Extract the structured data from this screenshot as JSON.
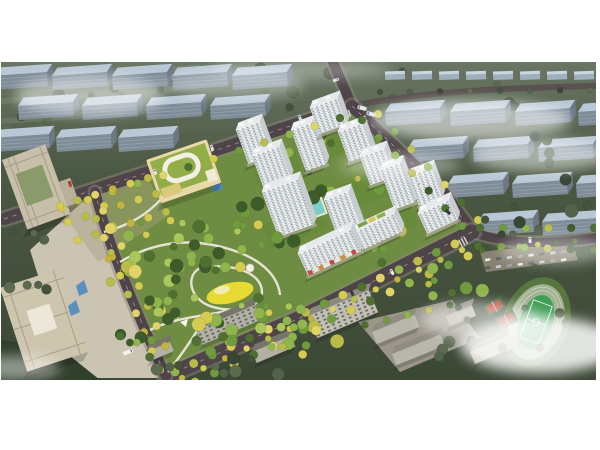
{
  "scene": {
    "description": "Aerial architectural rendering of a residential development master plan: white high-rise apartment towers around green courtyards, a large central landscaped park with winding white paths and a yellow playground, a kindergarten with a green roof, beige office towers on the left, tree-lined roads, a school with running track and basketball courts at lower right, surrounded by blue-grey context building blocks and drifting white fog",
    "image_width": 600,
    "image_height": 450,
    "render_area": {
      "x": 1,
      "y": 62,
      "w": 595,
      "h": 318
    }
  },
  "colors": {
    "canvas": "#ffffff",
    "ground_top": "#6a7663",
    "ground_mid": "#4b5843",
    "ground_bottom": "#3c4836",
    "site_green": "#6e8c42",
    "road": "#4e4449",
    "road_minor": "#5a5250",
    "sidewalk": "#8d867c",
    "road_dash": "#cfcac2",
    "context_roof": "#b9c8d6",
    "context_face": "#7f8d99",
    "context_side": "#6b7884",
    "context_line": "#95a3af",
    "tower_face": "#f0f2f0",
    "tower_side": "#c6ccd0",
    "tower_roof": "#e6e9eb",
    "window": "#5e6f7c",
    "gray_face": "#b3b1a6",
    "gray_roof": "#77746a",
    "office": "#cbc3ad",
    "office_shade": "#a79f89",
    "kindergarten_roof": "#93ae49",
    "kindergarten_wall": "#e9d9a9",
    "park_path": "#ebe8da",
    "playground": "#e8da34",
    "plaza": "#cbc4b2",
    "track_ring": "#a3b291",
    "pitch": "#3f9e58",
    "court": "#b44b3a",
    "pool": "#7ccdc9",
    "cloud": "#ffffff",
    "awning": [
      "#c9473e",
      "#e9e5da",
      "#d8863c",
      "#e9e5da"
    ]
  },
  "palettes": {
    "park": [
      "#4e7030",
      "#6f9a3e",
      "#8fb54c",
      "#3d5c2a",
      "#a9c75a",
      "#d3cb52"
    ],
    "site": [
      "#4e7030",
      "#6f9a3e",
      "#8fb54c",
      "#b9bc48",
      "#3d5c2a"
    ],
    "yellow": [
      "#d3cb52",
      "#b9bc48",
      "#e0d468",
      "#c4b43e"
    ],
    "mix": [
      "#d3cb52",
      "#6f9a3e",
      "#b9bc48",
      "#8fb54c",
      "#e0d468",
      "#4e7030"
    ],
    "context": [
      "#44523c",
      "#53624a",
      "#394635",
      "#5c6b50"
    ]
  },
  "context_slabs": [
    [
      -8,
      76
    ],
    [
      52,
      76
    ],
    [
      112,
      76
    ],
    [
      172,
      76
    ],
    [
      232,
      76
    ],
    [
      18,
      106
    ],
    [
      82,
      106
    ],
    [
      146,
      106
    ],
    [
      210,
      106
    ],
    [
      -6,
      138
    ],
    [
      56,
      138
    ],
    [
      118,
      138
    ],
    [
      385,
      112
    ],
    [
      450,
      112
    ],
    [
      515,
      112
    ],
    [
      578,
      112
    ],
    [
      408,
      148
    ],
    [
      473,
      148
    ],
    [
      538,
      148
    ],
    [
      448,
      184
    ],
    [
      512,
      184
    ],
    [
      576,
      184
    ],
    [
      478,
      222
    ],
    [
      542,
      222
    ]
  ],
  "houses": [
    [
      385,
      74
    ],
    [
      412,
      74
    ],
    [
      439,
      74
    ],
    [
      466,
      74
    ],
    [
      493,
      74
    ],
    [
      520,
      74
    ],
    [
      547,
      74
    ],
    [
      574,
      74
    ]
  ],
  "roads": [
    {
      "d": "M 4,219 L 352,106",
      "w": 12,
      "sw": true,
      "dash": true
    },
    {
      "d": "M 352,106 L 333,62",
      "w": 10,
      "sw": true,
      "dash": false
    },
    {
      "d": "M 352,106 C 420,92 500,88 596,86",
      "w": 6,
      "sw": false,
      "dash": false,
      "minor": true
    },
    {
      "d": "M 352,106 L 445,195 L 472,232",
      "w": 12,
      "sw": true,
      "dash": true
    },
    {
      "d": "M 472,232 C 515,247 558,243 596,238",
      "w": 9,
      "sw": true,
      "dash": false
    },
    {
      "d": "M 472,232 L 300,318 L 166,376",
      "w": 15,
      "sw": true,
      "dash": true
    },
    {
      "d": "M 95,192 C 110,250 135,310 166,376",
      "w": 10,
      "sw": true,
      "dash": true
    }
  ],
  "towers": [
    {
      "x": 236,
      "y": 130,
      "w": 25,
      "fh": 36,
      "rot": -20
    },
    {
      "x": 252,
      "y": 156,
      "w": 29,
      "fh": 34,
      "rot": -20
    },
    {
      "x": 291,
      "y": 130,
      "w": 22,
      "fh": 44,
      "rot": -20
    },
    {
      "x": 310,
      "y": 108,
      "w": 29,
      "fh": 28,
      "rot": -20
    },
    {
      "x": 338,
      "y": 132,
      "w": 26,
      "fh": 32,
      "rot": -20
    },
    {
      "x": 360,
      "y": 157,
      "w": 26,
      "fh": 30,
      "rot": -20
    },
    {
      "x": 380,
      "y": 170,
      "w": 22,
      "fh": 42,
      "rot": -20
    },
    {
      "x": 262,
      "y": 192,
      "w": 38,
      "fh": 48,
      "rot": -20
    },
    {
      "x": 324,
      "y": 200,
      "w": 26,
      "fh": 38,
      "rot": -20
    },
    {
      "x": 408,
      "y": 176,
      "w": 25,
      "fh": 32,
      "rot": -20
    },
    {
      "x": 354,
      "y": 232,
      "w": 44,
      "fh": 20,
      "rot": -25,
      "roofGarden": true
    },
    {
      "x": 298,
      "y": 254,
      "w": 58,
      "fh": 24,
      "rot": -25,
      "storefront": true
    },
    {
      "x": 418,
      "y": 214,
      "w": 34,
      "fh": 22,
      "rot": -25
    }
  ],
  "gray_slabs": [
    {
      "x": 196,
      "y": 330,
      "w": 64,
      "h": 16,
      "rot": -23,
      "win": true
    },
    {
      "x": 252,
      "y": 352,
      "w": 42,
      "h": 12,
      "rot": -23
    },
    {
      "x": 308,
      "y": 316,
      "w": 66,
      "h": 24,
      "rot": -23,
      "win": true,
      "face": "#c2bfb4",
      "roof": "#8c8a80"
    },
    {
      "x": 146,
      "y": 352,
      "w": 26,
      "h": 10,
      "rot": -23
    },
    {
      "x": 372,
      "y": 332,
      "w": 46,
      "h": 13,
      "rot": -22,
      "face": "#b9b6ab",
      "roof": "#8f8c81"
    },
    {
      "x": 392,
      "y": 354,
      "w": 52,
      "h": 12,
      "rot": -22,
      "face": "#b9b6ab",
      "roof": "#8f8c81"
    },
    {
      "x": 446,
      "y": 316,
      "w": 28,
      "h": 11,
      "rot": -22,
      "face": "#b9b6ab",
      "roof": "#8f8c81"
    },
    {
      "x": 470,
      "y": 352,
      "w": 40,
      "h": 13,
      "rot": -23
    }
  ],
  "tree_rows": [
    [
      62,
      208,
      340,
      118,
      12,
      4,
      "mix"
    ],
    [
      362,
      120,
      462,
      226,
      7,
      4,
      "site"
    ],
    [
      378,
      114,
      478,
      220,
      7,
      4,
      "mix"
    ],
    [
      455,
      244,
      175,
      372,
      16,
      4.5,
      "mix"
    ],
    [
      468,
      256,
      195,
      382,
      15,
      4.5,
      "mix"
    ],
    [
      462,
      250,
      182,
      378,
      14,
      3.2,
      "yellow"
    ],
    [
      88,
      200,
      160,
      370,
      10,
      4,
      "yellow"
    ],
    [
      104,
      206,
      174,
      366,
      9,
      4,
      "yellow"
    ],
    [
      480,
      228,
      594,
      228,
      6,
      4,
      "site"
    ],
    [
      478,
      246,
      594,
      250,
      6,
      4,
      "site"
    ],
    [
      60,
      206,
      148,
      178,
      6,
      4,
      "yellow"
    ],
    [
      68,
      222,
      156,
      194,
      6,
      4,
      "yellow"
    ],
    [
      78,
      240,
      166,
      212,
      6,
      4,
      "yellow"
    ],
    [
      482,
      250,
      575,
      241,
      6,
      3,
      "site"
    ],
    [
      365,
      325,
      450,
      305,
      5,
      3.5,
      "site"
    ],
    [
      380,
      92,
      590,
      90,
      8,
      3,
      "context"
    ]
  ],
  "tree_clusters": [
    {
      "cx": 290,
      "cy": 92,
      "rx": 290,
      "ry": 26,
      "n": 24,
      "seed": 7,
      "pal": "context",
      "layer": "back"
    },
    {
      "cx": 70,
      "cy": 125,
      "rx": 75,
      "ry": 38,
      "n": 9,
      "seed": 10,
      "pal": "context",
      "layer": "back"
    },
    {
      "cx": 330,
      "cy": 178,
      "rx": 68,
      "ry": 48,
      "n": 20,
      "seed": 6,
      "pal": "site",
      "layer": "court"
    },
    {
      "cx": 380,
      "cy": 240,
      "rx": 40,
      "ry": 25,
      "n": 8,
      "seed": 12,
      "pal": "site",
      "layer": "court"
    },
    {
      "cx": 170,
      "cy": 245,
      "rx": 55,
      "ry": 42,
      "n": 24,
      "seed": 1,
      "pal": "park",
      "layer": "front"
    },
    {
      "cx": 215,
      "cy": 305,
      "rx": 65,
      "ry": 48,
      "n": 26,
      "seed": 2,
      "pal": "park",
      "layer": "front"
    },
    {
      "cx": 262,
      "cy": 228,
      "rx": 42,
      "ry": 28,
      "n": 13,
      "seed": 3,
      "pal": "park",
      "layer": "front"
    },
    {
      "cx": 148,
      "cy": 330,
      "rx": 38,
      "ry": 30,
      "n": 12,
      "seed": 4,
      "pal": "park",
      "layer": "front"
    },
    {
      "cx": 282,
      "cy": 318,
      "rx": 30,
      "ry": 22,
      "n": 9,
      "seed": 5,
      "pal": "park",
      "layer": "front"
    },
    {
      "cx": 120,
      "cy": 255,
      "rx": 20,
      "ry": 35,
      "n": 8,
      "seed": 11,
      "pal": "yellow",
      "layer": "front"
    },
    {
      "cx": 532,
      "cy": 205,
      "rx": 64,
      "ry": 70,
      "n": 14,
      "seed": 8,
      "pal": "context",
      "layer": "front"
    },
    {
      "cx": 505,
      "cy": 330,
      "rx": 88,
      "ry": 42,
      "n": 12,
      "seed": 9,
      "pal": "context",
      "layer": "front"
    },
    {
      "cx": 28,
      "cy": 262,
      "rx": 26,
      "ry": 55,
      "n": 7,
      "seed": 13,
      "pal": "context",
      "layer": "front"
    },
    {
      "cx": 250,
      "cy": 368,
      "rx": 110,
      "ry": 12,
      "n": 9,
      "seed": 14,
      "pal": "context",
      "layer": "front"
    },
    {
      "cx": 452,
      "cy": 282,
      "rx": 40,
      "ry": 18,
      "n": 7,
      "seed": 15,
      "pal": "site",
      "layer": "front"
    },
    {
      "cx": 300,
      "cy": 340,
      "rx": 60,
      "ry": 16,
      "n": 10,
      "seed": 16,
      "pal": "mix",
      "layer": "front"
    }
  ],
  "park_paths": [
    "M 120,262 C 160,238 200,238 238,252 C 262,261 278,276 280,295",
    "M 200,268 C 230,262 262,272 262,292 C 262,308 232,314 210,306 C 190,299 185,276 200,268 Z",
    "M 104,232 C 130,225 148,214 162,198",
    "M 168,372 C 185,350 195,335 205,318",
    "M 150,330 C 185,312 225,318 258,300"
  ],
  "vehicles": [
    [
      70,
      184,
      -17,
      3,
      6,
      "#b8413a"
    ],
    [
      155,
      172,
      -17,
      3,
      6,
      "#dfe2e4"
    ],
    [
      212,
      148,
      -17,
      3,
      6,
      "#e8e8e8"
    ],
    [
      300,
      118,
      -20,
      3,
      6,
      "#d8dde0"
    ],
    [
      362,
      108,
      -75,
      4,
      9,
      "#e8e8e6"
    ],
    [
      371,
      114,
      -75,
      4,
      9,
      "#dfe3e6"
    ],
    [
      336,
      80,
      70,
      3,
      6,
      "#e0e4e8"
    ],
    [
      420,
      185,
      -48,
      3,
      6,
      "#e6e9ea"
    ],
    [
      448,
      212,
      -48,
      3,
      6,
      "#30363b"
    ],
    [
      530,
      240,
      -3,
      3,
      6,
      "#e8e8e8"
    ],
    [
      392,
      272,
      -27,
      3,
      6,
      "#eceff0"
    ],
    [
      352,
      293,
      -27,
      3,
      6,
      "#343a40"
    ],
    [
      128,
      352,
      68,
      4,
      10,
      "#f2f2ee"
    ]
  ],
  "clouds": [
    [
      90,
      95,
      75,
      20,
      0.5
    ],
    [
      235,
      85,
      70,
      14,
      0.35
    ],
    [
      300,
      70,
      90,
      10,
      0.3
    ],
    [
      470,
      120,
      100,
      20,
      0.55
    ],
    [
      540,
      155,
      70,
      16,
      0.5
    ],
    [
      400,
      165,
      60,
      12,
      0.35
    ],
    [
      555,
      250,
      55,
      14,
      0.4
    ],
    [
      480,
      320,
      60,
      18,
      0.5
    ],
    [
      540,
      345,
      80,
      28,
      0.85
    ],
    [
      15,
      368,
      45,
      12,
      0.45
    ]
  ]
}
